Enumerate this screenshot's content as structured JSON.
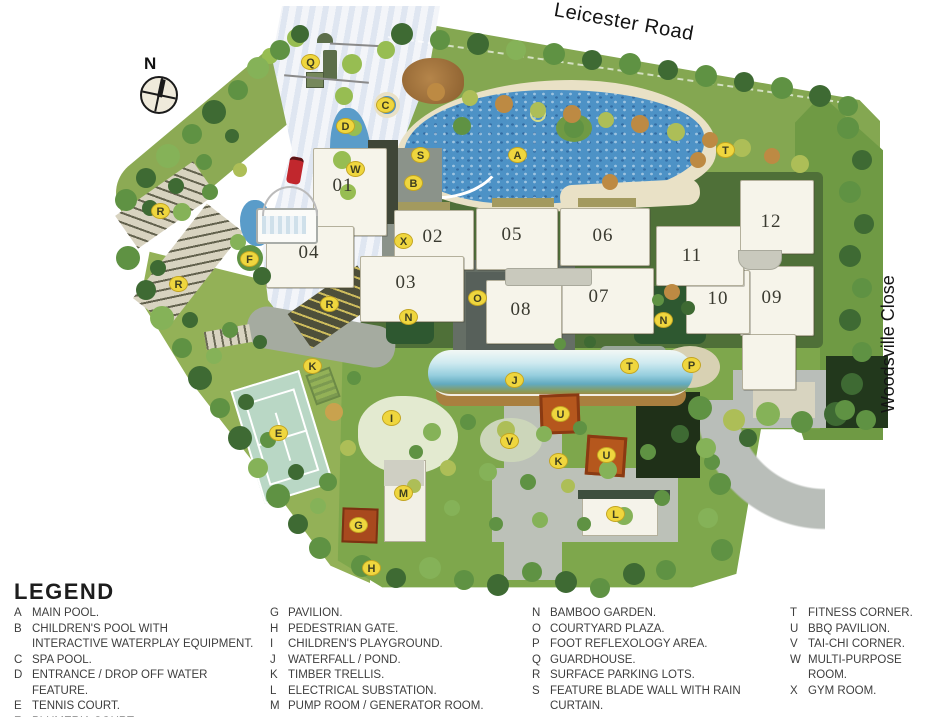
{
  "map": {
    "compass_label": "N",
    "road_top": "Leicester Road",
    "road_right": "Woodsville Close",
    "buildings": [
      {
        "label": "01",
        "x": 343,
        "y": 186
      },
      {
        "label": "02",
        "x": 433,
        "y": 237
      },
      {
        "label": "03",
        "x": 406,
        "y": 283
      },
      {
        "label": "04",
        "x": 309,
        "y": 253
      },
      {
        "label": "05",
        "x": 512,
        "y": 235
      },
      {
        "label": "06",
        "x": 603,
        "y": 236
      },
      {
        "label": "07",
        "x": 599,
        "y": 297
      },
      {
        "label": "08",
        "x": 521,
        "y": 310
      },
      {
        "label": "09",
        "x": 772,
        "y": 298
      },
      {
        "label": "10",
        "x": 718,
        "y": 299
      },
      {
        "label": "11",
        "x": 692,
        "y": 256
      },
      {
        "label": "12",
        "x": 771,
        "y": 222
      }
    ],
    "markers": [
      {
        "letter": "Q",
        "x": 310,
        "y": 62
      },
      {
        "letter": "C",
        "x": 385,
        "y": 105
      },
      {
        "letter": "D",
        "x": 345,
        "y": 126
      },
      {
        "letter": "S",
        "x": 420,
        "y": 155
      },
      {
        "letter": "A",
        "x": 517,
        "y": 155
      },
      {
        "letter": "B",
        "x": 413,
        "y": 183
      },
      {
        "letter": "W",
        "x": 355,
        "y": 169
      },
      {
        "letter": "T",
        "x": 725,
        "y": 150
      },
      {
        "letter": "X",
        "x": 403,
        "y": 241
      },
      {
        "letter": "F",
        "x": 249,
        "y": 259
      },
      {
        "letter": "R",
        "x": 160,
        "y": 211
      },
      {
        "letter": "R",
        "x": 178,
        "y": 284
      },
      {
        "letter": "R",
        "x": 329,
        "y": 304
      },
      {
        "letter": "O",
        "x": 477,
        "y": 298
      },
      {
        "letter": "N",
        "x": 408,
        "y": 317
      },
      {
        "letter": "N",
        "x": 663,
        "y": 320
      },
      {
        "letter": "K",
        "x": 312,
        "y": 366
      },
      {
        "letter": "T",
        "x": 629,
        "y": 366
      },
      {
        "letter": "P",
        "x": 691,
        "y": 365
      },
      {
        "letter": "J",
        "x": 514,
        "y": 380
      },
      {
        "letter": "I",
        "x": 391,
        "y": 418
      },
      {
        "letter": "U",
        "x": 560,
        "y": 414
      },
      {
        "letter": "E",
        "x": 278,
        "y": 433
      },
      {
        "letter": "V",
        "x": 509,
        "y": 441
      },
      {
        "letter": "K",
        "x": 558,
        "y": 461
      },
      {
        "letter": "U",
        "x": 606,
        "y": 455
      },
      {
        "letter": "M",
        "x": 403,
        "y": 493
      },
      {
        "letter": "G",
        "x": 358,
        "y": 525
      },
      {
        "letter": "L",
        "x": 615,
        "y": 514
      },
      {
        "letter": "H",
        "x": 371,
        "y": 568
      }
    ]
  },
  "legend": {
    "title": "LEGEND",
    "columns": [
      [
        {
          "key": "A",
          "lines": [
            "MAIN POOL."
          ]
        },
        {
          "key": "B",
          "lines": [
            "CHILDREN'S POOL WITH",
            "INTERACTIVE WATERPLAY EQUIPMENT."
          ]
        },
        {
          "key": "C",
          "lines": [
            "SPA POOL."
          ]
        },
        {
          "key": "D",
          "lines": [
            "ENTRANCE / DROP OFF WATER FEATURE."
          ]
        },
        {
          "key": "E",
          "lines": [
            "TENNIS COURT."
          ]
        },
        {
          "key": "F",
          "lines": [
            "PLUMERIA COURT."
          ]
        }
      ],
      [
        {
          "key": "G",
          "lines": [
            "PAVILION."
          ]
        },
        {
          "key": "H",
          "lines": [
            "PEDESTRIAN GATE."
          ]
        },
        {
          "key": "I",
          "lines": [
            "CHILDREN'S PLAYGROUND."
          ]
        },
        {
          "key": "J",
          "lines": [
            "WATERFALL / POND."
          ]
        },
        {
          "key": "K",
          "lines": [
            "TIMBER TRELLIS."
          ]
        },
        {
          "key": "L",
          "lines": [
            "ELECTRICAL SUBSTATION."
          ]
        },
        {
          "key": "M",
          "lines": [
            "PUMP ROOM / GENERATOR ROOM."
          ]
        }
      ],
      [
        {
          "key": "N",
          "lines": [
            "BAMBOO GARDEN."
          ]
        },
        {
          "key": "O",
          "lines": [
            "COURTYARD PLAZA."
          ]
        },
        {
          "key": "P",
          "lines": [
            "FOOT REFLEXOLOGY AREA."
          ]
        },
        {
          "key": "Q",
          "lines": [
            "GUARDHOUSE."
          ]
        },
        {
          "key": "R",
          "lines": [
            "SURFACE PARKING LOTS."
          ]
        },
        {
          "key": "S",
          "lines": [
            "FEATURE BLADE WALL WITH RAIN",
            "CURTAIN."
          ]
        }
      ],
      [
        {
          "key": "T",
          "lines": [
            "FITNESS CORNER."
          ]
        },
        {
          "key": "U",
          "lines": [
            "BBQ PAVILION."
          ]
        },
        {
          "key": "V",
          "lines": [
            "TAI-CHI CORNER."
          ]
        },
        {
          "key": "W",
          "lines": [
            "MULTI-PURPOSE ROOM."
          ]
        },
        {
          "key": "X",
          "lines": [
            "GYM ROOM."
          ]
        }
      ]
    ]
  }
}
